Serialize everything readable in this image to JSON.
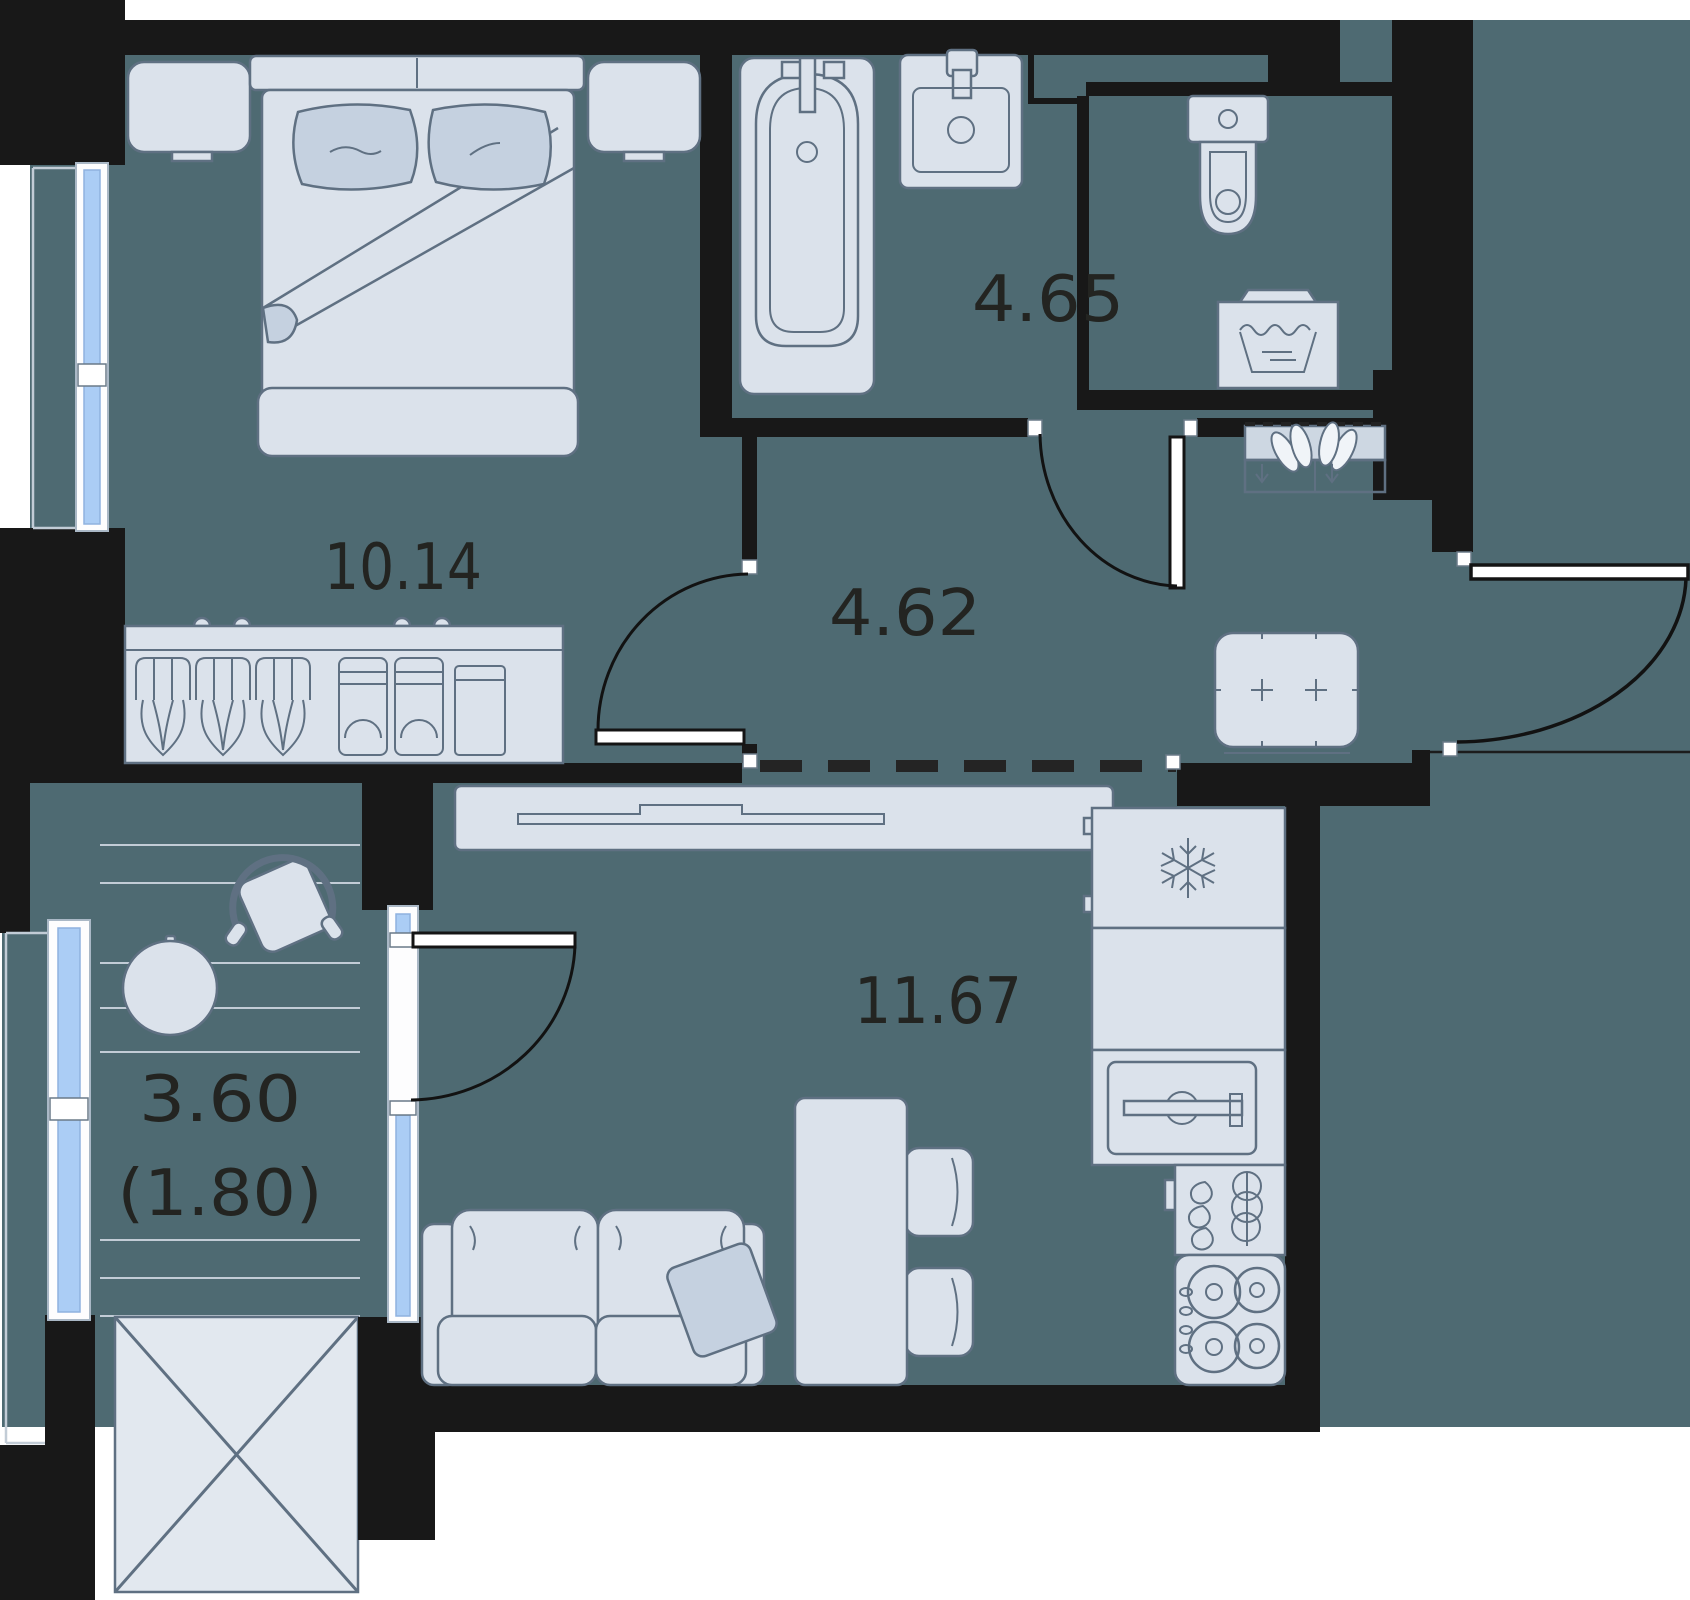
{
  "plan": {
    "title": "apartment-floor-plan",
    "labels": {
      "bedroom": "10.14",
      "bathroom": "4.65",
      "hallway": "4.62",
      "kitchen_living": "11.67",
      "balcony": "3.60",
      "balcony_reduced": "(1.80)"
    },
    "rooms": [
      {
        "id": "bedroom",
        "area_label": "10.14"
      },
      {
        "id": "bathroom",
        "area_label": "4.65"
      },
      {
        "id": "hallway",
        "area_label": "4.62"
      },
      {
        "id": "kitchen-living",
        "area_label": "11.67"
      },
      {
        "id": "balcony",
        "area_label": "3.60",
        "area_label_secondary": "(1.80)"
      }
    ],
    "icons": {
      "snowflake-icon": "fridge freezer symbol",
      "wash-basin-icon": "washing machine symbol",
      "shoe-pair-icon": "shoe rack shoes",
      "arrow-down-icon": "shoe rack slot arrow",
      "plus-icon": "ottoman tuft",
      "cross-box-icon": "balcony storage crossed box"
    },
    "colors": {
      "floor": "#4e6a72",
      "wall": "#181818",
      "furniture_fill": "#dbe2eb",
      "furniture_stroke": "#5f7082",
      "accent_fill": "#c5d1e0",
      "window_glass": "#abcdf5",
      "window_frame": "#fdfdfe",
      "label_text": "#232421",
      "plank_line": "#c2ccd6"
    }
  }
}
